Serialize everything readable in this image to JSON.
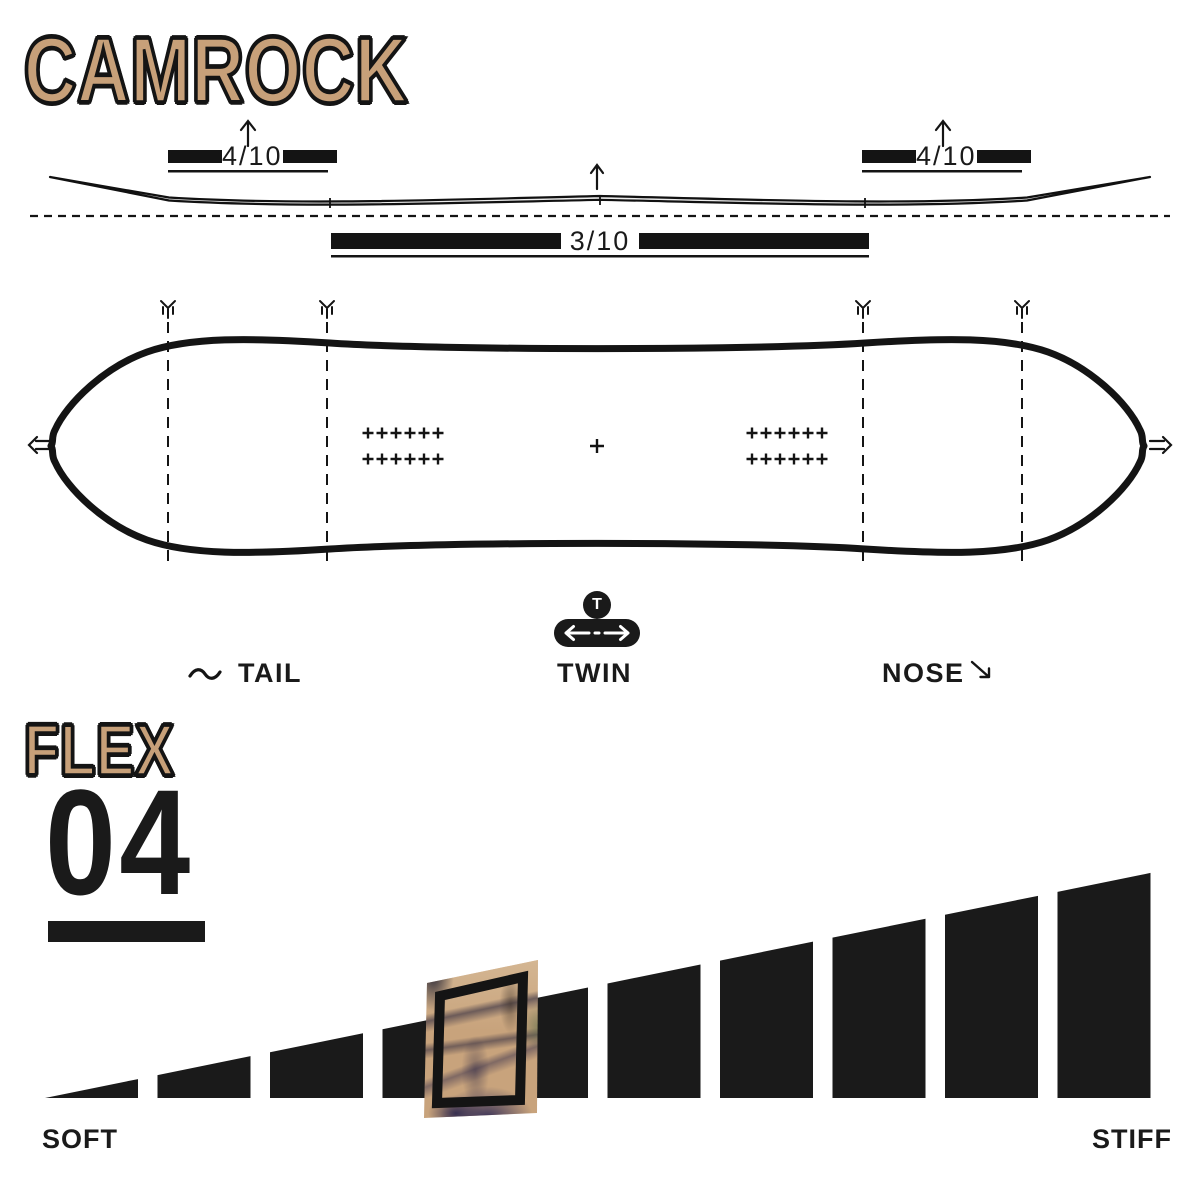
{
  "header": {
    "title": "CAMROCK"
  },
  "profile": {
    "left_tip_rating": "4/10",
    "right_tip_rating": "4/10",
    "camber_rating": "3/10"
  },
  "shape_labels": {
    "tail": "TAIL",
    "twin": "TWIN",
    "nose": "NOSE",
    "twin_badge": "T"
  },
  "flex": {
    "heading": "FLEX",
    "value": "04"
  },
  "chart_data": {
    "type": "bar",
    "title": "Flex rating scale",
    "categories": [
      1,
      2,
      3,
      4,
      5,
      6,
      7,
      8,
      9,
      10
    ],
    "values": [
      1,
      2,
      3,
      4,
      5,
      6,
      7,
      8,
      9,
      10
    ],
    "selected_level": 4,
    "xlabel_left": "SOFT",
    "xlabel_right": "STIFF",
    "bar_color": "#1a1a1a",
    "highlight_texture_color": "#c8a37c",
    "grid": false,
    "legend": "none"
  },
  "colors": {
    "ink": "#1a1a1a",
    "tan": "#c7a079",
    "background": "#ffffff"
  }
}
